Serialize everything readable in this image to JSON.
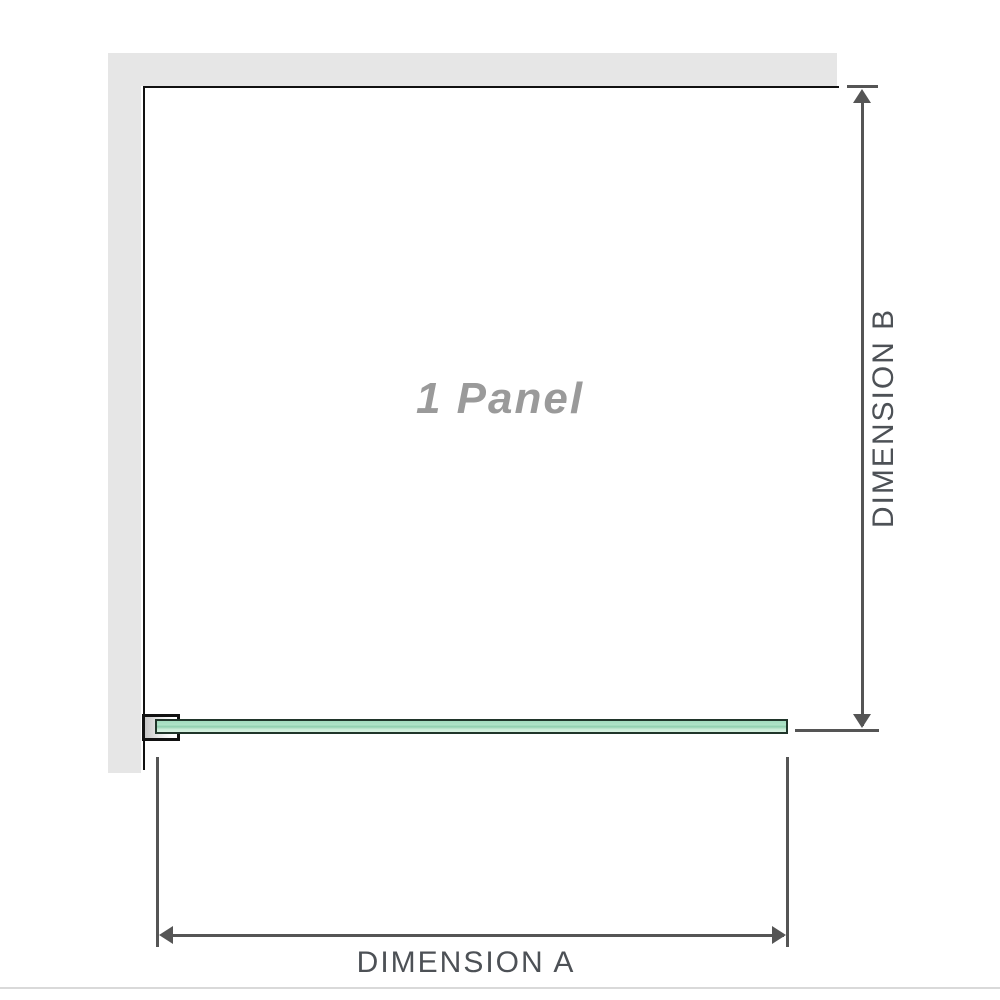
{
  "diagram": {
    "panel_label": "1 Panel",
    "dimension_a_label": "DIMENSION A",
    "dimension_b_label": "DIMENSION B"
  },
  "colors": {
    "wall_gray": "#e6e6e6",
    "outline_black": "#111111",
    "dimension_line_gray": "#555555",
    "label_gray": "#4d5156",
    "panel_text_gray": "#9a9a9a",
    "glass_green": "#a3dcbf",
    "glass_green_light": "#d8f2e2",
    "glass_border_dark": "#20352a",
    "bottom_border_gray": "#d9d9d9"
  }
}
